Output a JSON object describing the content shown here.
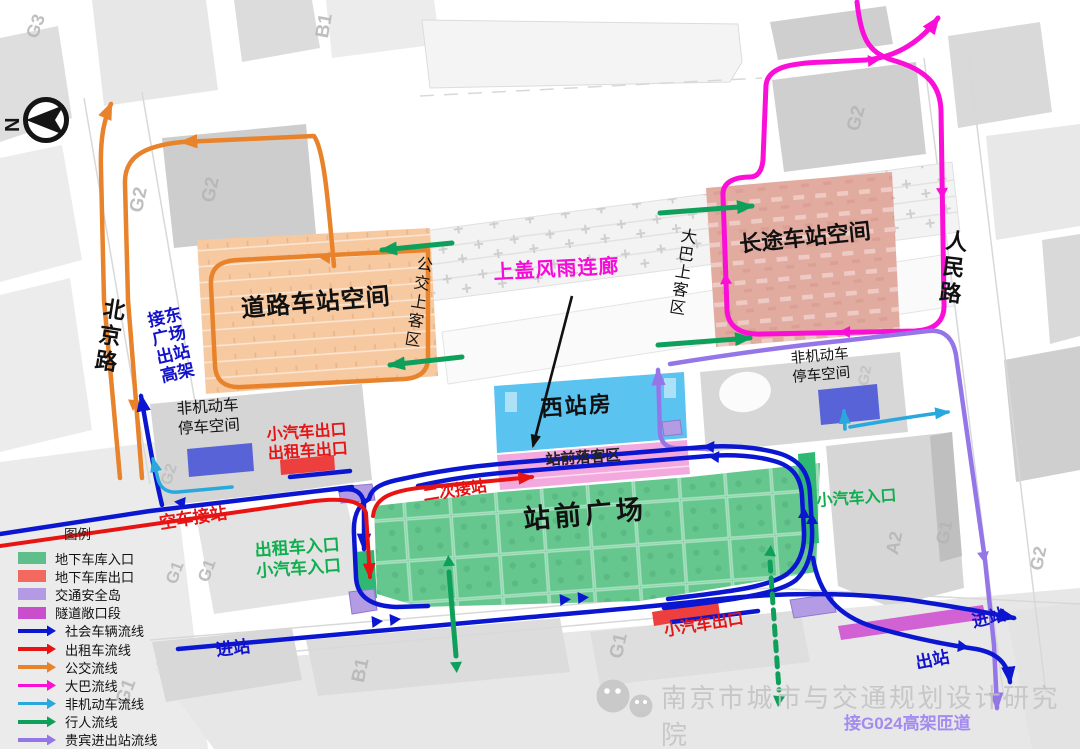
{
  "compass": {
    "north": "N"
  },
  "roads": {
    "beijing": "北京路",
    "renmin": "人民路",
    "labels": {
      "g1": "G1",
      "g2": "G2",
      "g3": "G3",
      "b1": "B1",
      "a2": "A2"
    }
  },
  "zones": {
    "road_station": "道路车站空间",
    "long_distance_station": "长途车站空间",
    "west_station": "西站房",
    "dropoff_area": "站前落客区",
    "station_plaza": "站前广场",
    "nonmotor_parking_left": "非机动车停车空间",
    "nonmotor_parking_right": "非机动车停车空间",
    "bus_boarding": "公交上客区",
    "coach_boarding": "大巴上客区"
  },
  "annotations": {
    "canopy": "上盖风雨连廊",
    "east_viaduct": "接东广场出站高架",
    "car_exit_left": "小汽车出口",
    "taxi_exit_left": "出租车出口",
    "empty_taxi_pickup": "空车接站",
    "taxi_entrance": "出租车入口",
    "car_entrance_left": "小汽车入口",
    "second_pickup": "二次接站",
    "car_entrance_right": "小汽车入口",
    "car_exit_bottom": "小汽车出口",
    "enter_station_west": "进站",
    "enter_station_east": "进站",
    "exit_station": "出站",
    "g024_ramp": "接G024高架匝道"
  },
  "legend": {
    "title": "图例",
    "swatches": [
      {
        "label": "地下车库入口",
        "color": "#5fbf8a"
      },
      {
        "label": "地下车库出口",
        "color": "#f4695f"
      },
      {
        "label": "交通安全岛",
        "color": "#b49ae4"
      },
      {
        "label": "隧道敞口段",
        "color": "#c94ecc"
      }
    ],
    "flows": [
      {
        "label": "社会车辆流线",
        "color": "#0b16d0"
      },
      {
        "label": "出租车流线",
        "color": "#e81414"
      },
      {
        "label": "公交流线",
        "color": "#e8832b"
      },
      {
        "label": "大巴流线",
        "color": "#fb0fd8"
      },
      {
        "label": "非机动车流线",
        "color": "#28a8dc"
      },
      {
        "label": "行人流线",
        "color": "#0ea05a"
      },
      {
        "label": "贵宾进出站流线",
        "color": "#9576e8"
      }
    ]
  },
  "zone_colors": {
    "road_station": "#f6c9a1",
    "long_distance_station": "#e2aba0",
    "west_station": "#5ac3ef",
    "dropoff_area": "#f4a9de",
    "station_plaza": "#65c78e",
    "garage_entry_strip": "#2eb873",
    "garage_exit_strip": "#ee3f3f",
    "safety_island": "#b49ce4",
    "tunnel_section": "#cf52d0",
    "nonmotor_parking": "#5863d8"
  },
  "watermark": "南京市城市与交通规划设计研究院"
}
